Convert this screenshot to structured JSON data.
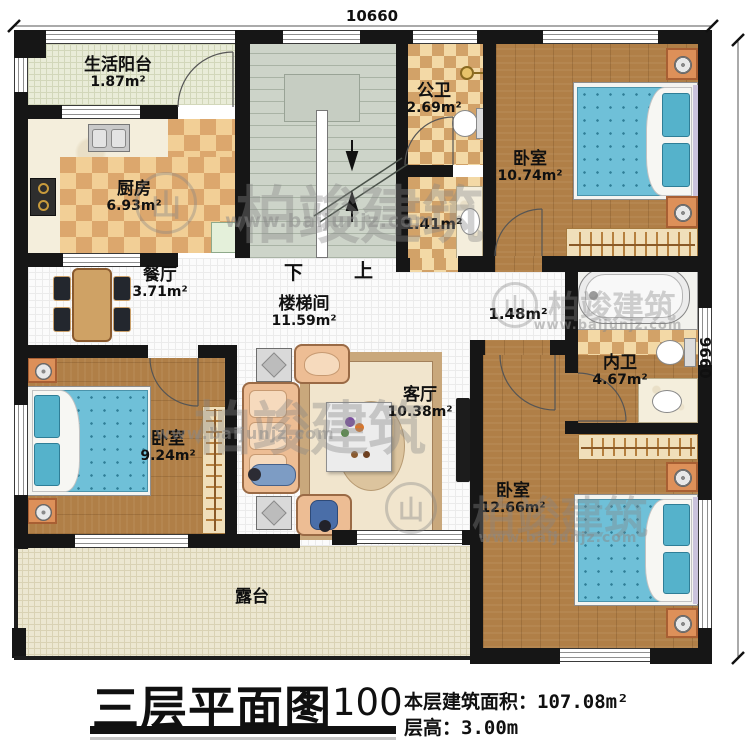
{
  "plan": {
    "dimensions": {
      "top": "10660",
      "right": "9660"
    },
    "stair_labels": {
      "down": "下",
      "up": "上"
    },
    "rooms": [
      {
        "id": "balcony",
        "name": "生活阳台",
        "area": "1.87m²"
      },
      {
        "id": "kitchen",
        "name": "厨房",
        "area": "6.93m²"
      },
      {
        "id": "dining",
        "name": "餐厅",
        "area": "3.71m²"
      },
      {
        "id": "stairwell",
        "name": "楼梯间",
        "area": "11.59m²"
      },
      {
        "id": "public-bath",
        "name": "公卫",
        "area": "2.69m²"
      },
      {
        "id": "wash-area",
        "name": "",
        "area": "1.41m²"
      },
      {
        "id": "bedroom-ne",
        "name": "卧室",
        "area": "10.74m²"
      },
      {
        "id": "hall-nook",
        "name": "",
        "area": "1.48m²"
      },
      {
        "id": "master-bath",
        "name": "内卫",
        "area": "4.67m²"
      },
      {
        "id": "bedroom-w",
        "name": "卧室",
        "area": "9.24m²"
      },
      {
        "id": "living",
        "name": "客厅",
        "area": "10.38m²"
      },
      {
        "id": "bedroom-se",
        "name": "卧室",
        "area": "12.66m²"
      },
      {
        "id": "terrace",
        "name": "露台",
        "area": ""
      }
    ]
  },
  "title_block": {
    "title": "三层平面图",
    "scale": "1:100",
    "area_label": "本层建筑面积：",
    "area_value": "107.08m²",
    "height_label": "层高：",
    "height_value": "3.00m"
  },
  "watermark": {
    "brand": "柏竣建筑",
    "url": "www.baijunjz.com",
    "logo_glyph": "山"
  },
  "colors": {
    "wall": "#161616",
    "wood_floor": "#b07f47",
    "tile_light": "#f2cf96",
    "tile_dark": "#dca76d",
    "bed_blue": "#6fc0d8",
    "sofa_peach": "#edbd94",
    "stair_gray": "#cdd4c9",
    "terrace": "#ece7d1"
  }
}
